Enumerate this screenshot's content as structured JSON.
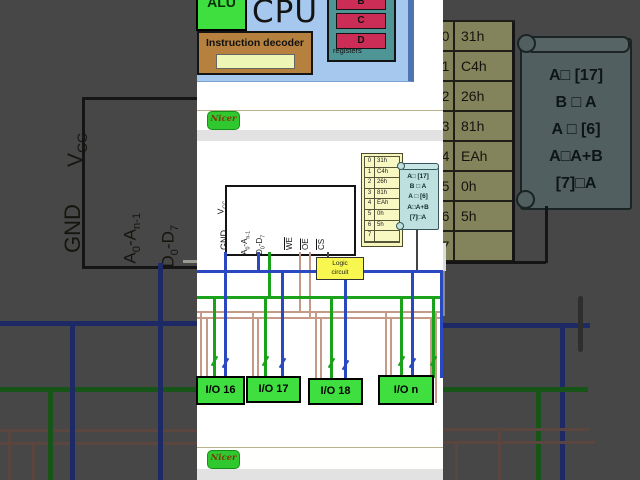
{
  "video": {
    "cpu_block": {
      "title": "CPU",
      "alu_label": "ALU",
      "decoder_label": "Instruction decoder",
      "registers_caption": "registers",
      "registers": [
        "B",
        "C",
        "D"
      ]
    },
    "toolbar": {
      "logo_text": "Nicer"
    },
    "chip": {
      "vcc_main": "V",
      "vcc_sub": "CC",
      "gnd": "GND",
      "addr_p1": "A",
      "addr_s1": "0",
      "addr_p2": "-A",
      "addr_s2": "n-1",
      "data_p1": "D",
      "data_s1": "0",
      "data_p2": "-D",
      "data_s2": "7",
      "we": "WE",
      "oe": "OE",
      "cs": "CS"
    },
    "memory_table": {
      "rows": [
        {
          "addr": "0",
          "value": "31h"
        },
        {
          "addr": "1",
          "value": "C4h"
        },
        {
          "addr": "2",
          "value": "26h"
        },
        {
          "addr": "3",
          "value": "81h"
        },
        {
          "addr": "4",
          "value": "EAh"
        },
        {
          "addr": "5",
          "value": "0h"
        },
        {
          "addr": "6",
          "value": "5h"
        },
        {
          "addr": "7",
          "value": ""
        }
      ]
    },
    "program_scroll": {
      "lines": [
        "A□ [17]",
        "B □ A",
        "A □ [6]",
        "A□A+B",
        "[7]□A"
      ]
    },
    "logic_box": {
      "line1": "Logic",
      "line2": "circuit"
    },
    "io_ports": [
      "I/O 16",
      "I/O 17",
      "I/O 18",
      "I/O n"
    ]
  },
  "colors": {
    "address_bus": "#2a49c0",
    "data_bus": "#1aa31a",
    "control_bus": "#c59a87",
    "cpu_fill": "#a6c7ee",
    "alu_fill": "#3fdf3f",
    "decoder_fill": "#b6813e",
    "register_fill": "#cb2d56",
    "register_panel": "#4f9596",
    "io_fill": "#3fdf3f",
    "table_fill": "#f8f8c2",
    "scroll_fill": "#bee0df",
    "logic_fill": "#f7f74f",
    "backdrop": "#474747"
  }
}
